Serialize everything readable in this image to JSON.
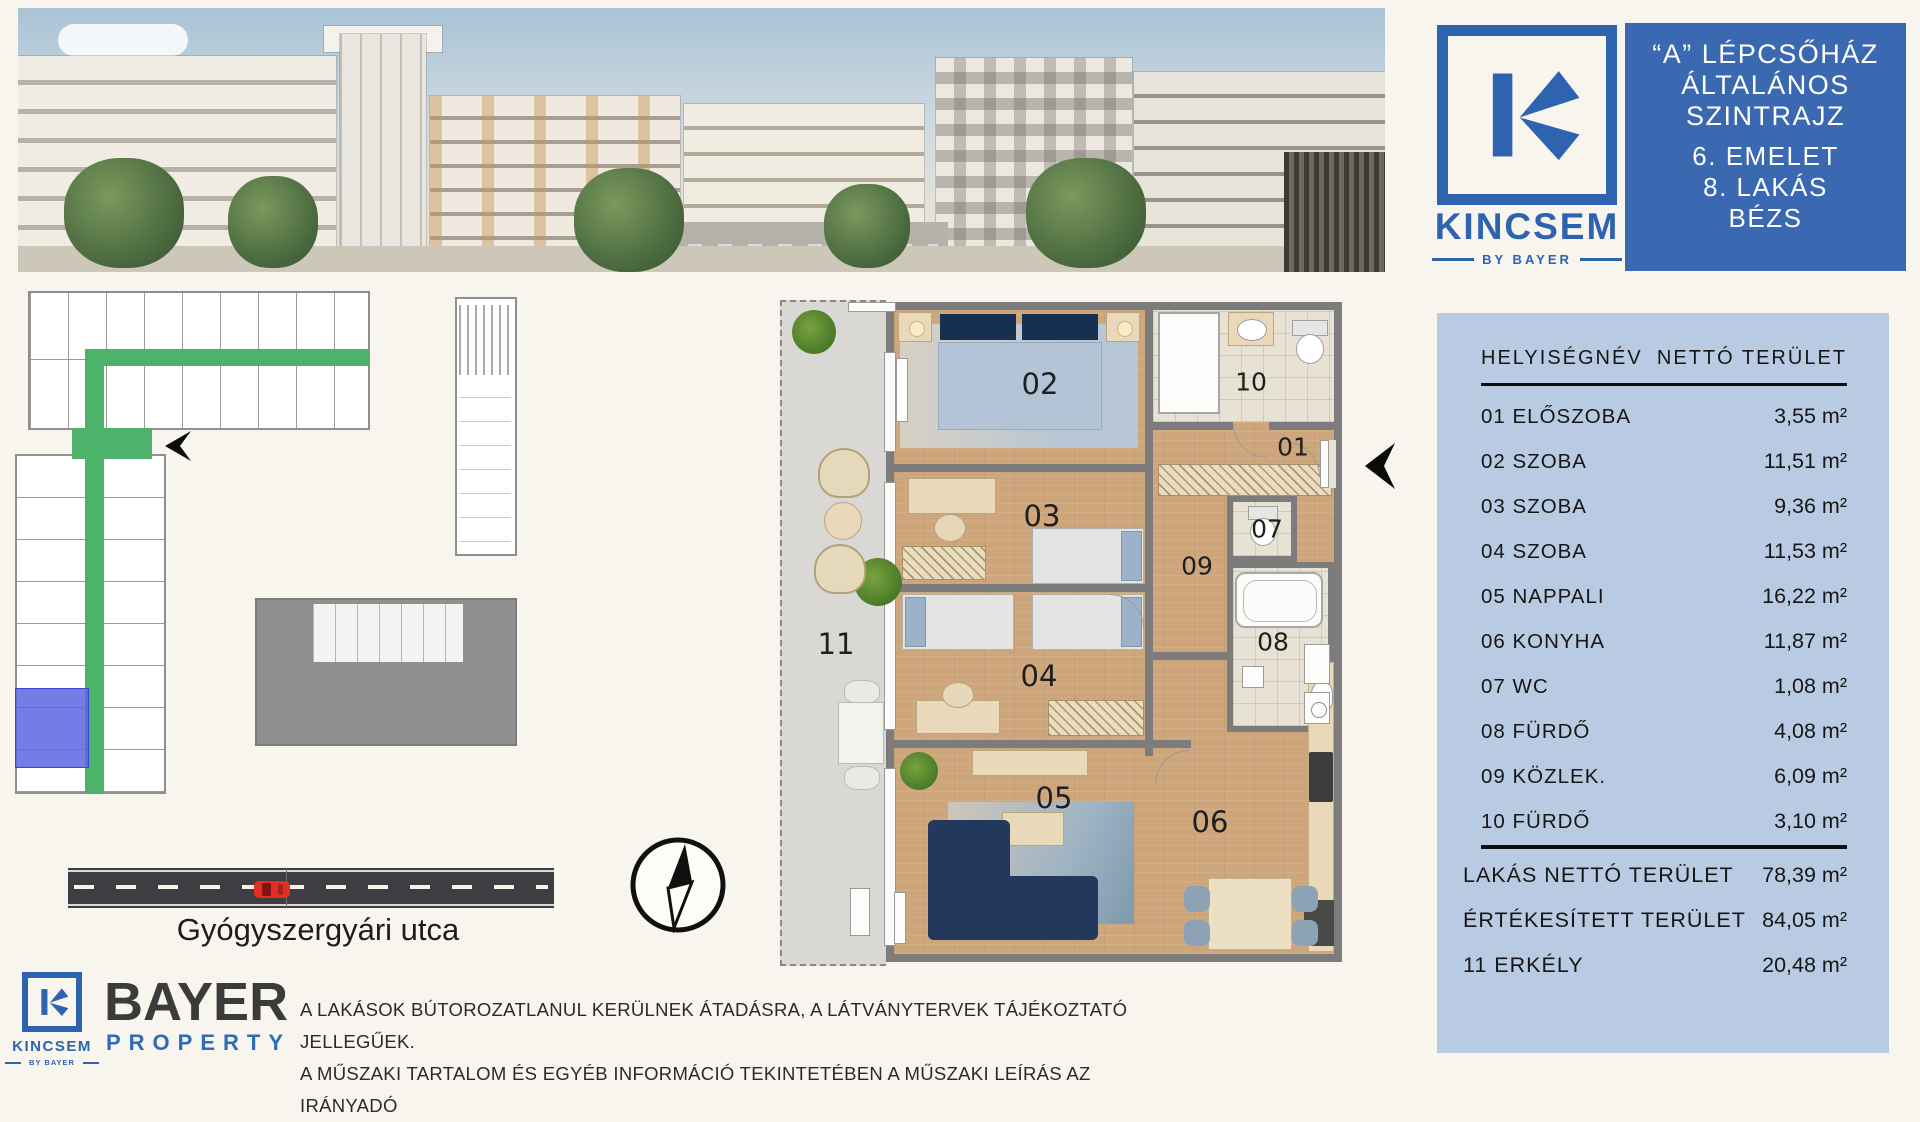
{
  "panel": {
    "title_lines": [
      "“A” LÉPCSŐHÁZ",
      "ÁLTALÁNOS",
      "SZINTRAJZ"
    ],
    "info_lines": [
      "6. EMELET",
      "8. LAKÁS",
      "BÉZS"
    ]
  },
  "brand": {
    "name": "KINCSEM",
    "sub": "BY BAYER"
  },
  "bayer": {
    "name": "BAYER",
    "sub": "PROPERTY"
  },
  "table": {
    "col_name": "HELYISÉGNÉV",
    "col_area": "NETTÓ TERÜLET",
    "rows": [
      {
        "name": "01 ELŐSZOBA",
        "area": "3,55 m²"
      },
      {
        "name": "02 SZOBA",
        "area": "11,51 m²"
      },
      {
        "name": "03 SZOBA",
        "area": "9,36 m²"
      },
      {
        "name": "04 SZOBA",
        "area": "11,53 m²"
      },
      {
        "name": "05 NAPPALI",
        "area": "16,22 m²"
      },
      {
        "name": "06 KONYHA",
        "area": "11,87 m²"
      },
      {
        "name": "07 WC",
        "area": "1,08 m²"
      },
      {
        "name": "08 FÜRDŐ",
        "area": "4,08 m²"
      },
      {
        "name": "09 KÖZLEK.",
        "area": "6,09 m²"
      },
      {
        "name": "10 FÜRDŐ",
        "area": "3,10 m²"
      }
    ],
    "summary": [
      {
        "name": "LAKÁS NETTÓ TERÜLET",
        "area": "78,39  m²"
      },
      {
        "name": "ÉRTÉKESÍTETT TERÜLET",
        "area": "84,05  m²"
      },
      {
        "name": "11 ERKÉLY",
        "area": "20,48 m²"
      }
    ]
  },
  "plan": {
    "rooms": [
      "01",
      "02",
      "03",
      "04",
      "05",
      "06",
      "07",
      "08",
      "09",
      "10",
      "11"
    ]
  },
  "site": {
    "street": "Gyógyszergyári utca"
  },
  "footer": {
    "disclaimer_line1": "A LAKÁSOK BÚTOROZATLANUL KERÜLNEK ÁTADÁSRA, A LÁTVÁNYTERVEK TÁJÉKOZTATÓ JELLEGŰEK.",
    "disclaimer_line2": "A MŰSZAKI TARTALOM ÉS EGYÉB INFORMÁCIÓ TEKINTETÉBEN A MŰSZAKI LEÍRÁS AZ IRÁNYADÓ"
  },
  "colors": {
    "brand_blue": "#2e63af",
    "panel_blue": "#3a69b2",
    "table_bg": "#b9cbe2",
    "corridor_green": "#4db36b",
    "unit_blue": "#5c66e0"
  }
}
